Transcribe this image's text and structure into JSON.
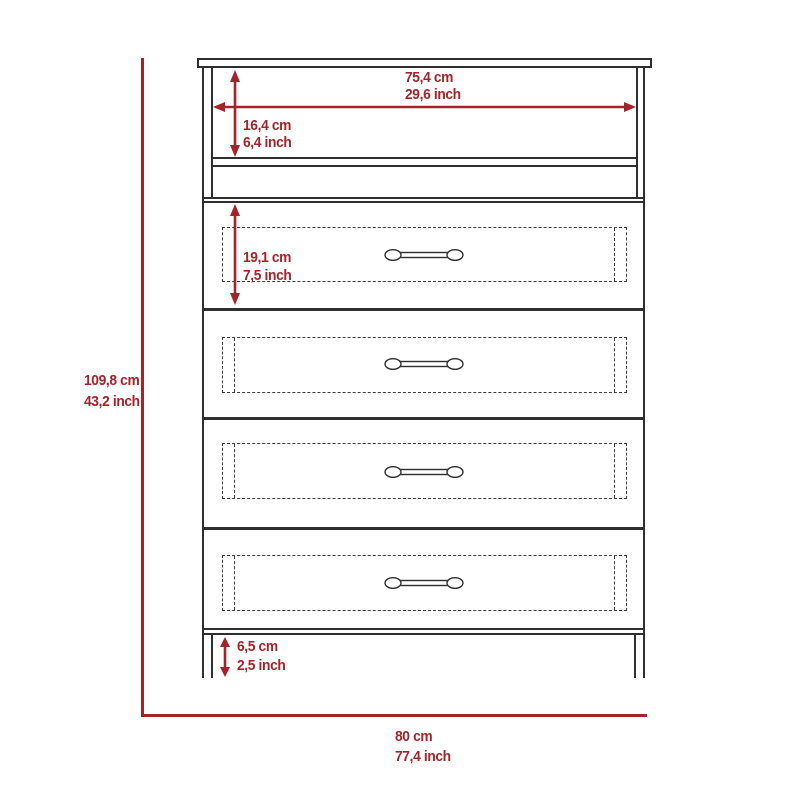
{
  "colors": {
    "dimension_red": "#A42329",
    "outline": "#2F2F2F"
  },
  "furniture": {
    "kind": "four-drawer-dresser-with-open-shelf",
    "drawer_count": 4
  },
  "dims": {
    "shelf_width": {
      "cm": "75,4 cm",
      "inch": "29,6 inch"
    },
    "shelf_height": {
      "cm": "16,4 cm",
      "inch": "6,4 inch"
    },
    "drawer_height": {
      "cm": "19,1 cm",
      "inch": "7,5 inch"
    },
    "overall_height": {
      "cm": "109,8 cm",
      "inch": "43,2 inch"
    },
    "leg_height": {
      "cm": "6,5 cm",
      "inch": "2,5 inch"
    },
    "overall_width": {
      "cm": "80 cm",
      "inch": "77,4 inch"
    }
  }
}
